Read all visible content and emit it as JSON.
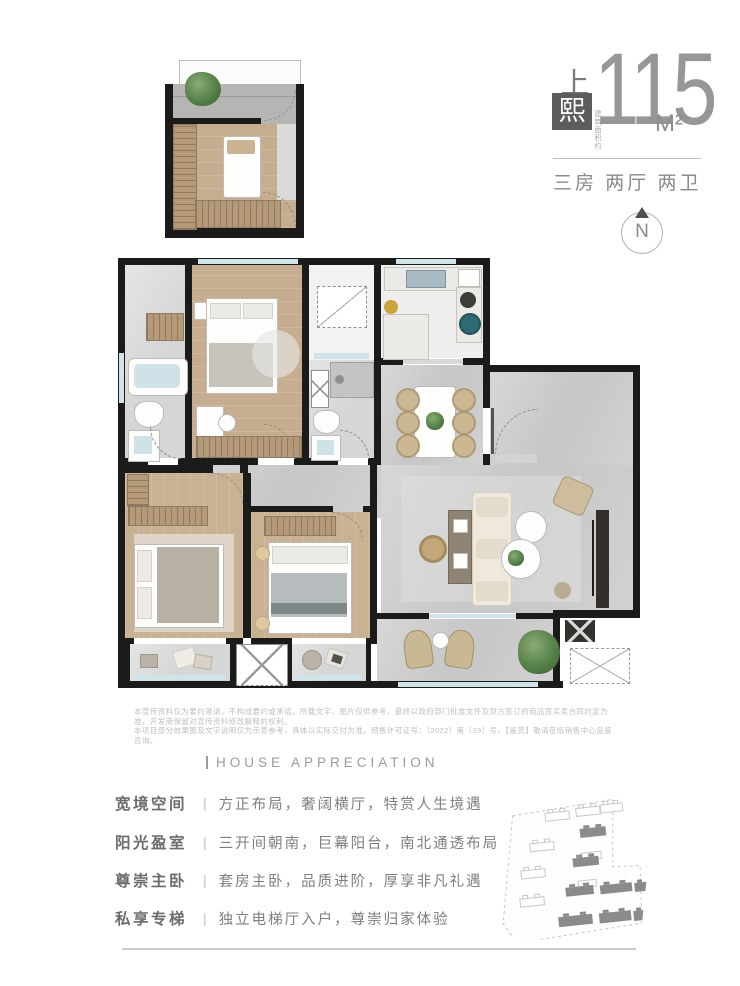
{
  "header": {
    "brand_top": "上",
    "brand_box": "熙",
    "area_note": "建筑面积约",
    "area_value": "115",
    "area_unit": "M²",
    "specs": "三房 两厅 两卫"
  },
  "compass": {
    "label": "N"
  },
  "disclaimer": {
    "line1": "本宣传资料仅为要约邀请，不构成要约或承诺，所载文字、图片仅供参考，最终以政府部门批准文件及双方签订的商品房买卖合同约定为准，开发商保留对宣传资料修改解释的权利。",
    "line2": "本项目部分效果图及文字说明仅为示意参考，具体以实际交付为准。预售许可证号：〔2022〕第〔39〕号，【鉴赏】敬请莅临销售中心品鉴咨询。"
  },
  "appreciation": {
    "heading": "HOUSE APPRECIATION",
    "separator": "|",
    "features": [
      {
        "title": "宽境空间",
        "desc": "方正布局，奢阔横厅，特赏人生境遇"
      },
      {
        "title": "阳光盈室",
        "desc": "三开间朝南，巨幕阳台，南北通透布局"
      },
      {
        "title": "尊崇主卧",
        "desc": "套房主卧，品质进阶，厚享非凡礼遇"
      },
      {
        "title": "私享专梯",
        "desc": "独立电梯厅入户，尊崇归家体验"
      }
    ]
  },
  "colors": {
    "wall_black": "#1b1b1a",
    "window_blue": "#cfe3e9",
    "brand_box_bg": "#5e5d5b",
    "number_gray": "#97979a",
    "text_gray": "#7e7e7c"
  }
}
